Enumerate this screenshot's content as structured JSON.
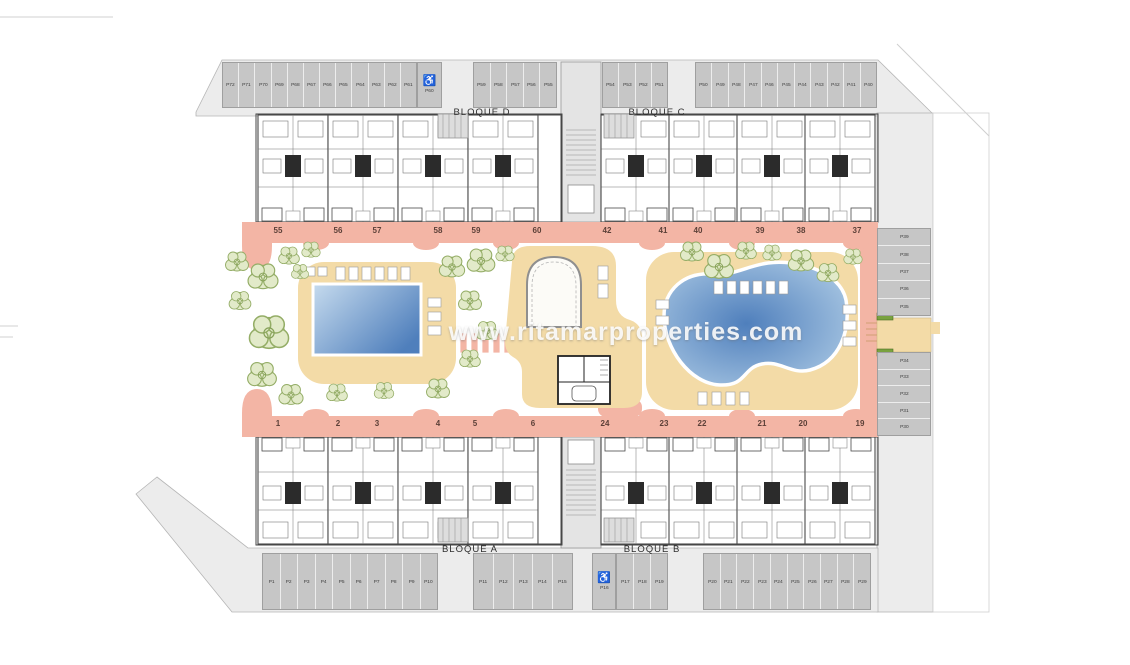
{
  "site": {
    "watermark": "www.ritamarproperties.com"
  },
  "blocks": {
    "bloque_d": "BLOQUE D",
    "bloque_c": "BLOQUE C",
    "bloque_a": "BLOQUE A",
    "bloque_b": "BLOQUE B"
  },
  "unit_numbers": {
    "top": [
      "55",
      "56",
      "57",
      "58",
      "59",
      "60",
      "42",
      "41",
      "40",
      "39",
      "38",
      "37"
    ],
    "bottom": [
      "1",
      "2",
      "3",
      "4",
      "5",
      "6",
      "24",
      "23",
      "22",
      "21",
      "20",
      "19"
    ]
  },
  "parking": {
    "accessible_icon": "♿",
    "groups": [
      {
        "id": "top-a",
        "labels": [
          "P72",
          "P71",
          "P70",
          "P69",
          "P68",
          "P67",
          "P66",
          "P65",
          "P64",
          "P63",
          "P62",
          "P61"
        ]
      },
      {
        "id": "top-acc",
        "labels": [
          "P60"
        ],
        "accessible": true
      },
      {
        "id": "top-b",
        "labels": [
          "P59",
          "P58",
          "P57",
          "P56",
          "P55"
        ]
      },
      {
        "id": "top-c",
        "labels": [
          "P54",
          "P53",
          "P52",
          "P51"
        ]
      },
      {
        "id": "top-d",
        "labels": [
          "P50",
          "P49",
          "P48",
          "P47",
          "P46",
          "P45",
          "P44",
          "P43",
          "P42",
          "P41",
          "P40"
        ]
      },
      {
        "id": "right-upper",
        "labels": [
          "P39",
          "P38",
          "P37",
          "P36",
          "P35"
        ]
      },
      {
        "id": "right-lower",
        "labels": [
          "P34",
          "P33",
          "P32",
          "P31",
          "P30"
        ]
      },
      {
        "id": "bottom-a",
        "labels": [
          "P1",
          "P2",
          "P3",
          "P4",
          "P5",
          "P6",
          "P7",
          "P8",
          "P9",
          "P10"
        ]
      },
      {
        "id": "bottom-b",
        "labels": [
          "P11",
          "P12",
          "P13",
          "P14",
          "P15"
        ]
      },
      {
        "id": "bottom-acc",
        "labels": [
          "P16"
        ],
        "accessible": true
      },
      {
        "id": "bottom-c",
        "labels": [
          "P17",
          "P18",
          "P19"
        ]
      },
      {
        "id": "bottom-d",
        "labels": [
          "P20",
          "P21",
          "P22",
          "P23",
          "P24",
          "P25",
          "P26",
          "P27",
          "P28",
          "P29"
        ]
      }
    ]
  },
  "colors": {
    "walkway": "#f3b5a5",
    "deck": "#f3dba7",
    "stall": "#c6c6c6",
    "road": "#ececec",
    "tree": "#e2eac9",
    "pool_light": "#c6dbee",
    "pool_dark": "#4f7fbc"
  }
}
